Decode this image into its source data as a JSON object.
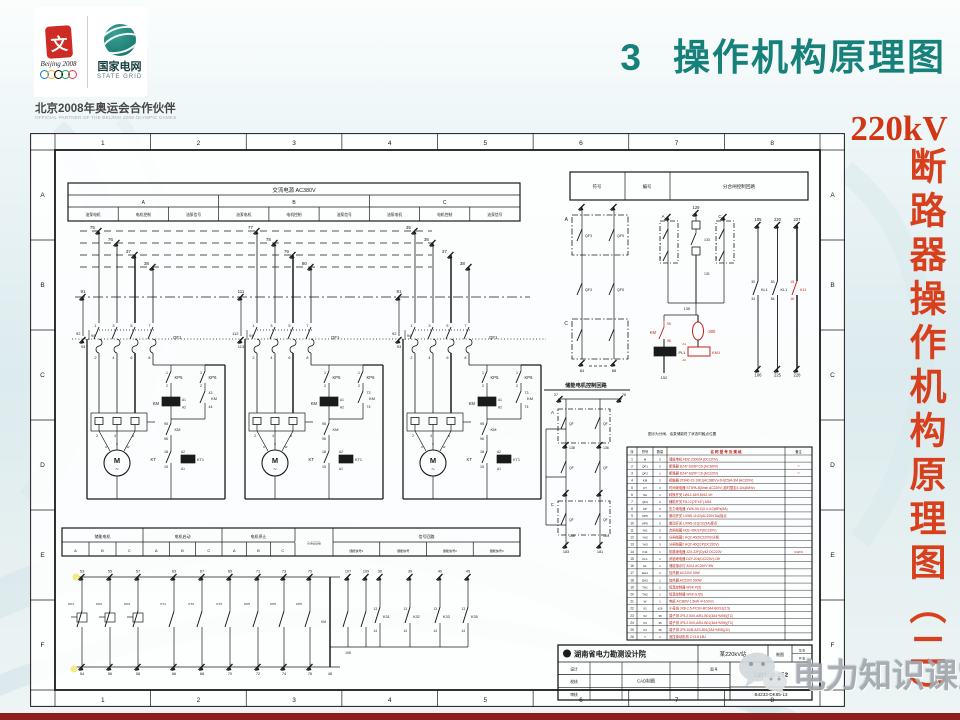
{
  "slide": {
    "title_number": "3",
    "title_text": "操作机构原理图",
    "side_title_top": "220kV",
    "side_title_chars": "断路器操作机构原理图（二）",
    "watermark_text": "电力知识课堂"
  },
  "partner_block": {
    "emblem_char": "文",
    "beijing_script": "Beijing 2008",
    "grid_cn": "国家电网",
    "grid_en": "STATE GRID",
    "partner_cn": "北京2008年奥运会合作伙伴",
    "partner_en": "OFFICIAL PARTNER OF THE BEIJING 2008 OLYMPIC GAMES"
  },
  "schematic": {
    "frame": {
      "cols": [
        "1",
        "2",
        "3",
        "4",
        "5",
        "6",
        "7",
        "8"
      ],
      "rows": [
        "A",
        "B",
        "C",
        "D",
        "E",
        "F"
      ]
    },
    "power_table": {
      "title": "交流电源 AC380V",
      "phases": [
        "A",
        "B",
        "C"
      ],
      "subcols": [
        "油泵电机",
        "电机控制",
        "油泵信号"
      ]
    },
    "motor_common": {
      "qf": "QF1",
      "pole_top": [
        "1",
        "3",
        "5",
        "7"
      ],
      "pole_bot": [
        "2",
        "4",
        "6",
        "8"
      ],
      "kp5": "KP5",
      "kp6": "KP6",
      "km": "KM",
      "coil": [
        "A1",
        "A2"
      ],
      "hold": [
        "95",
        "96"
      ],
      "kt": "KT",
      "kt_nums": [
        "18",
        "15"
      ],
      "kt_coil": [
        "A2",
        "KT1",
        "A1"
      ],
      "kp_nums": [
        "1",
        "2"
      ],
      "ov_nums": [
        "2",
        "4",
        "6"
      ],
      "motor": "M",
      "motor_phases": [
        "U",
        "V",
        "W"
      ]
    },
    "motor_blocks": [
      {
        "drops": [
          "75",
          "76",
          "37",
          "38"
        ],
        "riser": [
          "91",
          "92",
          "93",
          "94"
        ],
        "aux": [
          "43",
          "44"
        ]
      },
      {
        "drops": [
          "77",
          "78",
          "79",
          "80"
        ],
        "riser": [
          "111",
          "112",
          "113",
          "94"
        ],
        "aux": [
          "73",
          "74"
        ]
      },
      {
        "drops": [
          "35",
          "36",
          "37",
          "38"
        ],
        "riser": [
          "91",
          "92",
          "93",
          "94"
        ],
        "aux": [
          "73",
          "74"
        ]
      }
    ],
    "right_table": {
      "cells": [
        "符号",
        "编号",
        "分合闸控制回路"
      ]
    },
    "group1": {
      "label_a": "A",
      "label_c": "C",
      "contact": "QF3",
      "contact2": "QF5",
      "feet": [
        "84",
        "88"
      ]
    },
    "group2": {
      "top": "129",
      "label_a": "A",
      "label_c": "C",
      "mids": [
        "133",
        "131",
        "135"
      ],
      "side_nums": [
        "1",
        "3",
        "5"
      ]
    },
    "red_cluster": {
      "km": "KM",
      "n95": "95",
      "n98": "98",
      "oval": "-300",
      "pl": "PL1",
      "km1": "KM1",
      "a1": "A1",
      "a2": "A2",
      "foot": "152",
      "color": "#c22218"
    },
    "long_lines": [
      {
        "top": "105",
        "bottom": "106",
        "c_top": "30",
        "c_bot": "34",
        "label": "KL1",
        "red": false
      },
      {
        "top": "220",
        "bottom": "225",
        "c_top": "83",
        "c_bot": "84",
        "label": "KL1",
        "red": false
      },
      {
        "top": "227",
        "bottom": "228",
        "c_top": "15",
        "c_bot": "16",
        "label": "K11",
        "red": true
      }
    ],
    "chu": {
      "label": "储能电机控制回路",
      "top_nums": [
        "27",
        "28"
      ],
      "label_a": "A",
      "label_c": "C",
      "qf": "QF",
      "mid_nums": [
        "138",
        "136"
      ],
      "low_nums": [
        "168",
        "164"
      ],
      "feet": [
        "183",
        "181"
      ]
    },
    "note": "图示为分闸、油泵储能终了状态时触点位置",
    "bottom_table": {
      "groups": [
        {
          "label": "储能电机",
          "subs": [
            "A",
            "B",
            "C"
          ]
        },
        {
          "label": "电机启动",
          "subs": [
            "A",
            "B",
            "C"
          ]
        },
        {
          "label": "电机停止",
          "subs": [
            "A",
            "B",
            "C"
          ]
        },
        {
          "label": "防跳回路",
          "subs": []
        },
        {
          "label": "信号回路",
          "subs": [
            "储能信号1",
            "储能信号",
            "储能信号2",
            "储能信号3"
          ]
        }
      ]
    },
    "bottom_contacts": {
      "cols": [
        {
          "x": 52,
          "t": "53",
          "b": "54",
          "s": "KP1",
          "box": true
        },
        {
          "x": 80,
          "t": "55",
          "b": "56",
          "s": "KP2",
          "box": true
        },
        {
          "x": 108,
          "t": "57",
          "b": "58",
          "s": "KP3",
          "box": true
        },
        {
          "x": 144,
          "t": "63",
          "b": "66",
          "s": "KT1",
          "box": false
        },
        {
          "x": 172,
          "t": "67",
          "b": "68",
          "s": "KT2",
          "box": false
        },
        {
          "x": 200,
          "t": "69",
          "b": "70",
          "s": "KT3",
          "box": false
        },
        {
          "x": 228,
          "t": "71",
          "b": "72",
          "s": "KP5",
          "box": false
        },
        {
          "x": 254,
          "t": "73",
          "b": "74",
          "s": "KP5",
          "box": false
        },
        {
          "x": 280,
          "t": "75",
          "b": "76",
          "s": "KP5",
          "box": false
        }
      ],
      "long_col": {
        "x": 300,
        "b": "48",
        "s": "KM"
      },
      "sa_cols": [
        {
          "x": 318,
          "t": "107",
          "b": "108"
        },
        {
          "x": 336,
          "t": "109",
          "b": ""
        }
      ],
      "k_cols": [
        {
          "x": 350,
          "t": "36",
          "l": "K31"
        },
        {
          "x": 380,
          "t": "39",
          "l": "K32"
        },
        {
          "x": 410,
          "t": "40",
          "l": "K33"
        },
        {
          "x": 438,
          "t": "45",
          "l": "K35"
        }
      ],
      "k_nums": [
        "13",
        "14"
      ]
    },
    "parts_table": {
      "headers": [
        "序",
        "符号",
        "数量",
        "名 称 型 号 及 规 格",
        "备注"
      ],
      "rows": [
        [
          "1",
          "M",
          "3",
          "储能电机 HDZ-23002A (DC220V)",
          ""
        ],
        [
          "2",
          "QF1",
          "3",
          "断路器 DZ47-63/3P C6 (AC380V)",
          "**"
        ],
        [
          "3",
          "QF2",
          "1",
          "断路器 DZ47-63/2P C6 (AC220V)",
          "**"
        ],
        [
          "4",
          "KM",
          "3",
          "接触器 3TB40-22-10E1(AC380V)+2H(C5)A-3M (AC220V)",
          ""
        ],
        [
          "5",
          "KT",
          "3",
          "时间继电器 ST3PA-B(5min,AC220V)  延时整定4-10s(50Hz)",
          ""
        ],
        [
          "6",
          "SA",
          "1",
          "转换开关 LW12-16/9.5512.1H",
          ""
        ],
        [
          "7",
          "QF3",
          "3",
          "辅助开关 F8-12(75°±5°)-M16",
          ""
        ],
        [
          "8",
          "KP",
          "3",
          "压力继电器 YWK-50-C(0.4-4.0)MPa(5A)",
          ""
        ],
        [
          "9",
          "KP5",
          "3",
          "微动开关 LXW5-11G2(AC220V,5A)接点",
          ""
        ],
        [
          "10",
          "KP6",
          "3",
          "微动开关 LXW5-11Q/1C(5A)接点",
          ""
        ],
        [
          "11",
          "YA1",
          "3",
          "合闸线圈 HQ2-40K/1P(DC220V)",
          ""
        ],
        [
          "12",
          "YA2",
          "3",
          "分闸线圈1 HQ2-40(DC220V)/分相",
          ""
        ],
        [
          "13",
          "YA3",
          "3",
          "分闸线圈2 HQ2-40Q/1P(DC220V)",
          ""
        ],
        [
          "14",
          "K11",
          "1",
          "防跳继电器 JZX-22F(D)/4Z DC220V",
          "GWF6"
        ],
        [
          "15",
          "KL1",
          "1",
          "闭锁继电器 DZY-204(DC220V)-1W",
          ""
        ],
        [
          "16",
          "HL",
          "1",
          "储能指示灯 AD11 AC220V 5W",
          ""
        ],
        [
          "17",
          "EH1",
          "1",
          "加热器 AC220V 50W",
          ""
        ],
        [
          "18",
          "EH2",
          "1",
          "加热器 AC220V 500W",
          ""
        ],
        [
          "19",
          "TH1",
          "1",
          "恒温控制器 WSK-P(5)",
          ""
        ],
        [
          "20",
          "TH2",
          "1",
          "恒温控制器 WSK-SJ(5)",
          ""
        ],
        [
          "21",
          "W",
          "1",
          "电缆 AC380V 1.5kW 4×10/mm",
          ""
        ],
        [
          "22",
          "X1",
          "±26",
          "小母线 JXB-2.5-PC30/-BC3A4 B0/S1(2.5)",
          ""
        ],
        [
          "23",
          "X2",
          "35",
          "端子排 JF5-2.5X0-A/B1-B01(3A4+M06)(TC)",
          ""
        ],
        [
          "24",
          "X3",
          "35",
          "端子排 JF5-2.5X0-A/B1-B01(3A4+M06)(TC)",
          ""
        ],
        [
          "25",
          "X4",
          "35",
          "端子排 JF5-10/B-A2S-B01(2A4+M08)(JC)",
          ""
        ],
        [
          "26",
          "Y",
          "1",
          "液压操动机构 CY3-Ⅱ 18U",
          ""
        ]
      ]
    },
    "title_block": {
      "institute": "湖南省电力勘测设计院",
      "station": "某220kV站",
      "draw_label": "制图",
      "sheet_no": "第 张",
      "sheet_total": "共 张",
      "left_labels": [
        "设计",
        "校核",
        "审核"
      ],
      "cad": "CAD制图",
      "fig_label": "图 号",
      "model": "LW10B-252",
      "drawing_no": "B4233-DK85-13"
    }
  }
}
